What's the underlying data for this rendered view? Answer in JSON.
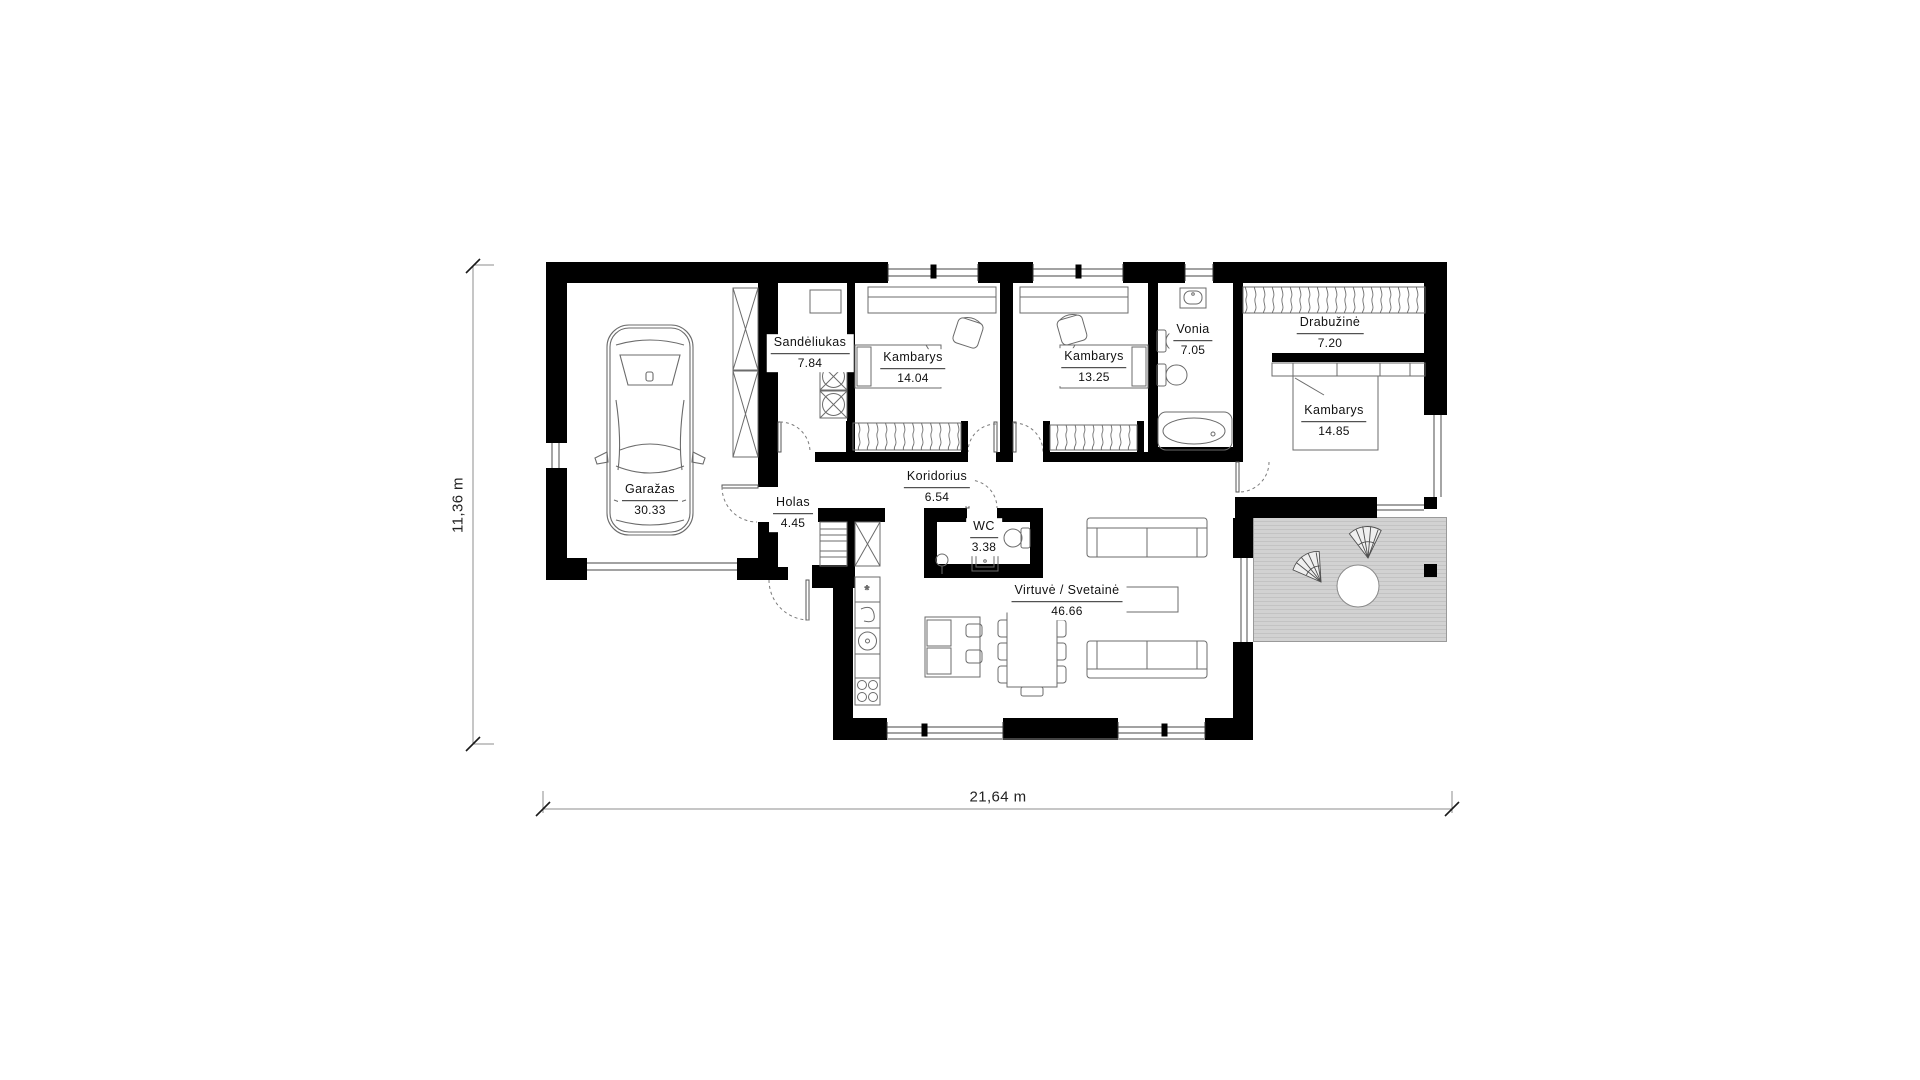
{
  "plan": {
    "rooms": [
      {
        "name": "Garažas",
        "area": "30.33"
      },
      {
        "name": "Sandėliukas",
        "area": "7.84"
      },
      {
        "name": "Kambarys",
        "area": "14.04"
      },
      {
        "name": "Kambarys",
        "area": "13.25"
      },
      {
        "name": "Vonia",
        "area": "7.05"
      },
      {
        "name": "Drabužinė",
        "area": "7.20"
      },
      {
        "name": "Kambarys",
        "area": "14.85"
      },
      {
        "name": "Koridorius",
        "area": "6.54"
      },
      {
        "name": "Holas",
        "area": "4.45"
      },
      {
        "name": "WC",
        "area": "3.38"
      },
      {
        "name": "Virtuvė / Svetainė",
        "area": "46.66"
      }
    ],
    "dimensions": {
      "bottom": "21,64 m",
      "left": "11,36 m"
    },
    "colors": {
      "wall": "#000000",
      "furniture_line": "#6b6b6b",
      "terrace": "#d2d2d2",
      "dim_line": "#8c8c8c"
    }
  }
}
